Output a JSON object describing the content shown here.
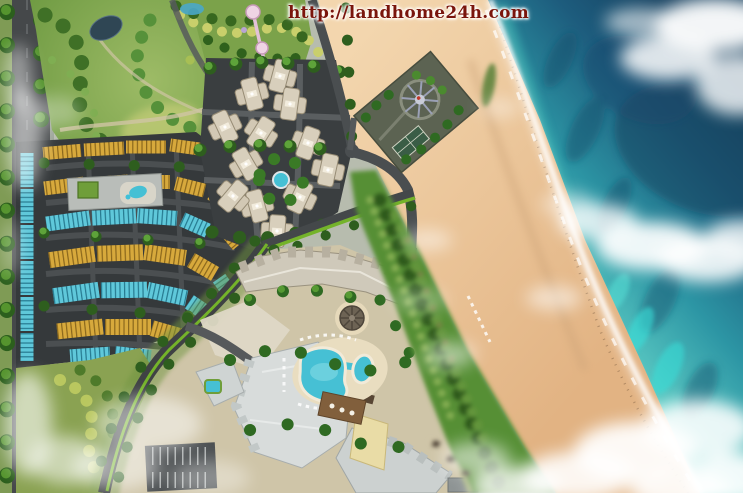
{
  "watermark": {
    "url": "http://landhome24h.com",
    "color": "#7a150c"
  },
  "scene": {
    "title": "beachfront resort master plan aerial rendering",
    "regions": [
      "central-park",
      "amusement-garden",
      "pond",
      "condominium-cluster",
      "townhouse-district",
      "clubhouse",
      "boulevard",
      "resort-hotel",
      "lagoon-pools",
      "pool-bar",
      "beach-club-plaza",
      "tennis-court",
      "parking-lot",
      "coastal-dune-forest",
      "beach",
      "surf-line",
      "ocean",
      "clouds"
    ]
  },
  "palette": {
    "ocean_deep": "#16405f",
    "ocean_mid": "#1d5c7d",
    "ocean_shallow": "#5fcfc6",
    "sand_light": "#f3d6ae",
    "sand_dark": "#e2b383",
    "roof_yellow": "#d7a93c",
    "roof_blue": "#5fc8da",
    "pool": "#46c0d4",
    "vegetation": "#568f36",
    "road": "#45484a",
    "resort_roof": "#cfc9ba"
  }
}
